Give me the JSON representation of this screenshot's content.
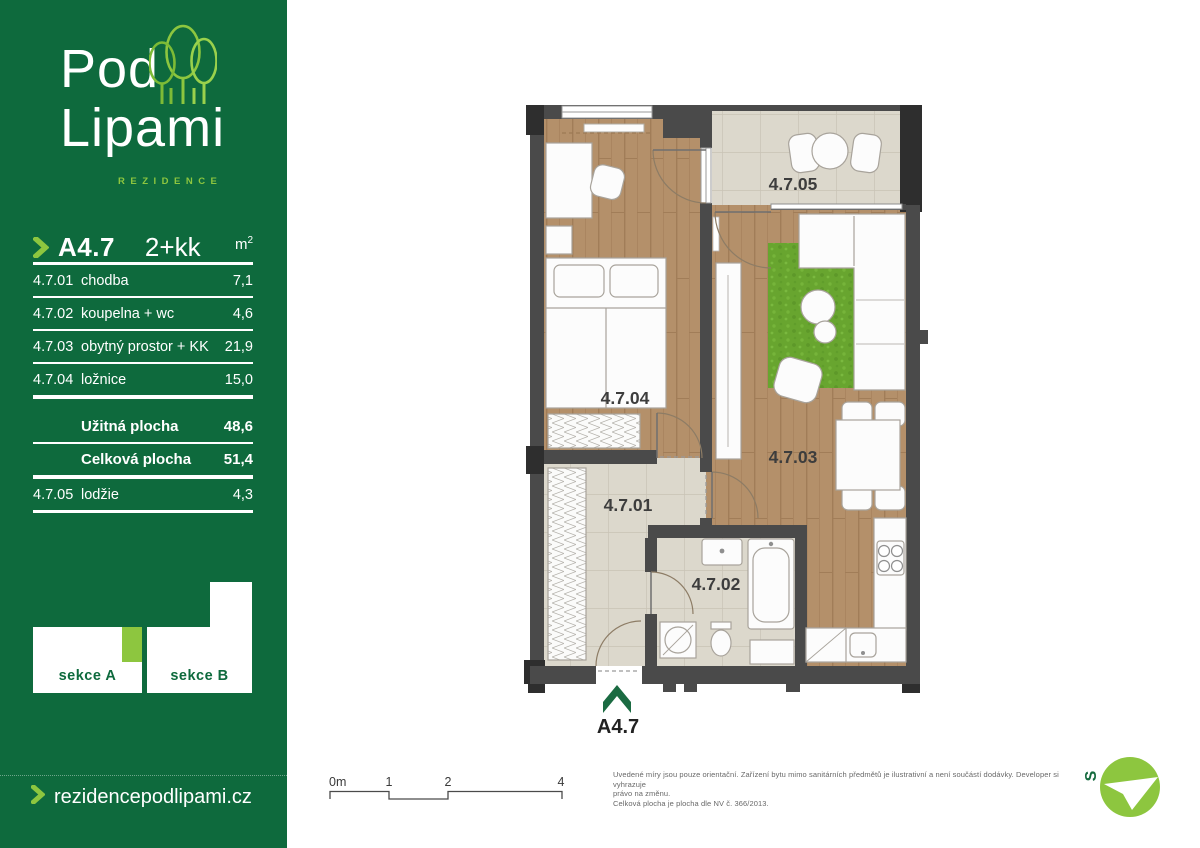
{
  "sidebar": {
    "brand": {
      "line1": "Pod",
      "line2": "Lipami",
      "tagline": "REZIDENCE"
    },
    "header": {
      "code": "A4.7",
      "layout": "2+kk",
      "unit": "m",
      "unit_sup": "2"
    },
    "rooms": [
      {
        "code": "4.7.01",
        "name": "chodba",
        "area": "7,1"
      },
      {
        "code": "4.7.02",
        "name": "koupelna + wc",
        "area": "4,6"
      },
      {
        "code": "4.7.03",
        "name": "obytný prostor + KK",
        "area": "21,9"
      },
      {
        "code": "4.7.04",
        "name": "ložnice",
        "area": "15,0"
      }
    ],
    "totals": [
      {
        "label": "Užitná plocha",
        "value": "48,6"
      },
      {
        "label": "Celková plocha",
        "value": "51,4"
      }
    ],
    "loggia_row": {
      "code": "4.7.05",
      "name": "lodžie",
      "area": "4,3"
    },
    "sections": {
      "a": "sekce A",
      "b": "sekce B"
    },
    "website": "rezidencepodlipami.cz"
  },
  "plan": {
    "room_labels": {
      "r01": "4.7.01",
      "r02": "4.7.02",
      "r03": "4.7.03",
      "r04": "4.7.04",
      "r05": "4.7.05"
    },
    "entry_label": "A4.7",
    "north_label": "S"
  },
  "scale_bar": {
    "labels": [
      "0m",
      "1",
      "2",
      "4"
    ]
  },
  "disclaimer": {
    "line1": "Uvedené míry jsou pouze orientační. Zařízení bytu mimo sanitárních předmětů je ilustrativní a není součástí dodávky. Developer si vyhrazuje",
    "line2": "právo na změnu.",
    "line3": "Celková plocha je plocha dle NV č. 366/2013."
  },
  "colors": {
    "brand_green": "#0e6a3d",
    "accent_green": "#8dc63f",
    "wall_gray": "#4a4a4a",
    "wood": "#b4906a",
    "tile": "#dcd8cc",
    "rug_green": "#68a52f"
  }
}
